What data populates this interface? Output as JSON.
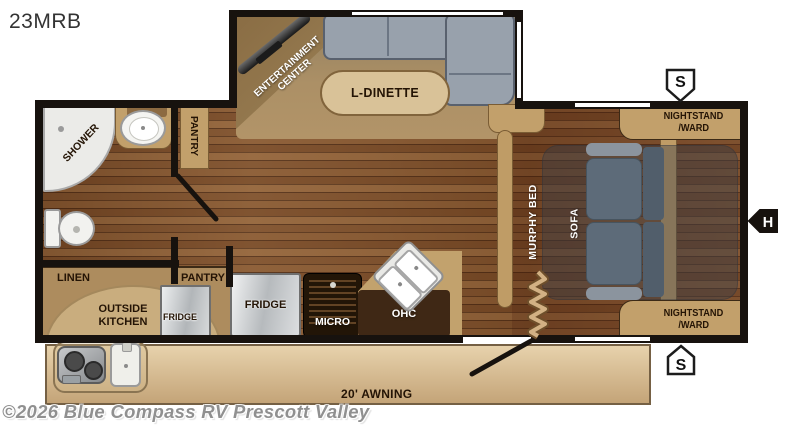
{
  "title": "23MRB",
  "watermark": "©2026 Blue Compass RV Prescott Valley",
  "labels": {
    "entertainment_line1": "ENTERTAINMENT",
    "entertainment_line2": "CENTER",
    "l_dinette": "L-DINETTE",
    "pantry_upper": "PANTRY",
    "shower": "SHOWER",
    "linen": "LINEN",
    "pantry_lower": "PANTRY",
    "outside_kitchen_line1": "OUTSIDE",
    "outside_kitchen_line2": "KITCHEN",
    "fridge_outside": "FRIDGE",
    "fridge_main": "FRIDGE",
    "micro": "MICRO",
    "ohc": "OHC",
    "murphy_bed": "MURPHY BED",
    "sofa": "SOFA",
    "nightstand_top_line1": "NIGHTSTAND",
    "nightstand_top_line2": "/WARD",
    "nightstand_bottom_line1": "NIGHTSTAND",
    "nightstand_bottom_line2": "/WARD",
    "awning": "20' AWNING"
  },
  "markers": {
    "speaker_top": "S",
    "speaker_bottom": "S",
    "water_heater": "H"
  },
  "colors": {
    "wall": "#17120e",
    "floor_wood": "#84552c",
    "cabinet_tan": "#c2a06b",
    "slide_floor": "#a68c62",
    "dinette_gray": "#98a1ac",
    "sofa_gray": "#5d6b79",
    "awning": "#d6b98e",
    "shower_white": "#ebebe8"
  }
}
